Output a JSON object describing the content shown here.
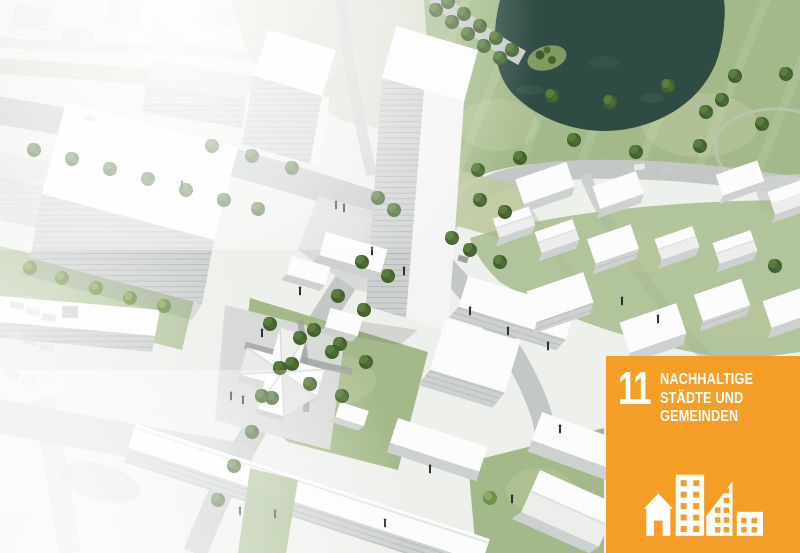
{
  "scene": {
    "type": "architectural-aerial-rendering",
    "description": "Bird's-eye visualization of an urban district masterplan: white model buildings and high-rise towers along tree-lined streets, central lawns, a large park with a dark pond and island at the top right, and the faded existing neighbourhood at the image edges",
    "colors": {
      "background": "#eef0ec",
      "grass": "#a3b989",
      "grass_light": "#bdc99e",
      "pond": "#2e4b44",
      "road": "#c3c7c6",
      "plaza": "#d8dad8",
      "building_roof": "#fbfcfb",
      "building_face": "#cdd1d0",
      "tree": "#42612f"
    }
  },
  "badge": {
    "goal_number": "11",
    "title_line1": "NACHHALTIGE",
    "title_line2": "STÄDTE UND",
    "title_line3": "GEMEINDEN",
    "background_color": "#F59E27",
    "text_color": "#FFFFFF",
    "icon": "sdg11-city-buildings-icon"
  }
}
